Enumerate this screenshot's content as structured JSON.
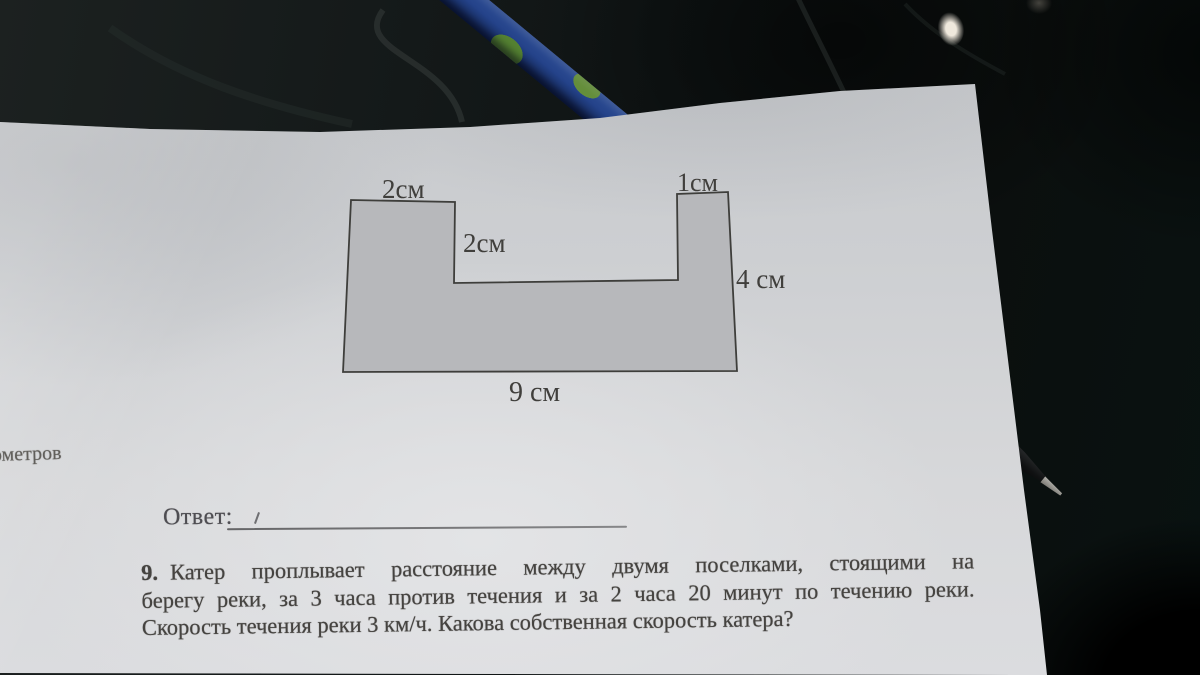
{
  "figure": {
    "labels": {
      "top_left": "2см",
      "inner": "2см",
      "top_right": "1см",
      "right": "4 см",
      "bottom": "9 см"
    },
    "fill_color": "#b7b8bb",
    "outline_color": "#3e3e3b"
  },
  "page": {
    "cut_word_left": "ометров",
    "answer_label": "Ответ:",
    "problem": {
      "number": "9.",
      "line1": "Катер проплывает расстояние между двумя поселками, стоящими на",
      "line2": "берегу реки, за 3 часа против течения и за 2 часа 20 минут по течению реки.",
      "line3": "Скорость течения реки 3 км/ч. Какова собственная скорость катера?"
    }
  },
  "colors": {
    "paper": "#d2d3d6",
    "ink": "#454340",
    "table_dark": "#0d1110",
    "pen_blue": "#2b55b8",
    "pen_camo_green": "#79b53f"
  }
}
